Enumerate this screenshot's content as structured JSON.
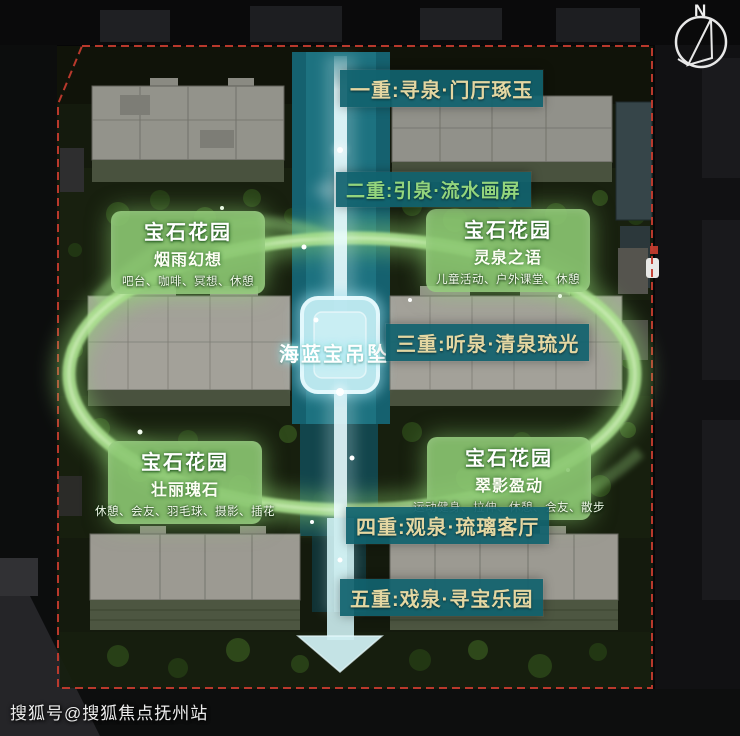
{
  "compass": {
    "north_label": "N"
  },
  "watermark": {
    "text": "搜狐号@搜狐焦点抚州站"
  },
  "center": {
    "pendant_label": "海蓝宝吊坠"
  },
  "sequence_labels": {
    "level1": "一重:寻泉·门厅琢玉",
    "level2": "二重:引泉·流水画屏",
    "level3": "三重:听泉·清泉琉光",
    "level4": "四重:观泉·琉璃客厅",
    "level5": "五重:戏泉·寻宝乐园"
  },
  "gardens": {
    "top_left": {
      "title": "宝石花园",
      "subtitle": "烟雨幻想",
      "features": "吧台、咖啡、冥想、休憩"
    },
    "top_right": {
      "title": "宝石花园",
      "subtitle": "灵泉之语",
      "features": "儿童活动、户外课堂、休憩"
    },
    "bottom_left": {
      "title": "宝石花园",
      "subtitle": "壮丽瑰石",
      "features": "休憩、会友、羽毛球、摄影、插花"
    },
    "bottom_right": {
      "title": "宝石花园",
      "subtitle": "翠影盈动",
      "features": "运动健身、拉伸、休憩、会友、散步"
    }
  },
  "colors": {
    "label_box_teal": "#11626E",
    "label_text_cream": "#E4D7A2",
    "label_text_green": "#93D57D",
    "garden_box_green": "#8CC872",
    "loop_ring_green": "#A5DC8B",
    "water_axis_teal": "#15616F",
    "beam_cyan": "#E4F9FB",
    "pendant_blue": "#BCE8EF",
    "boundary_red": "#C23B2E"
  }
}
